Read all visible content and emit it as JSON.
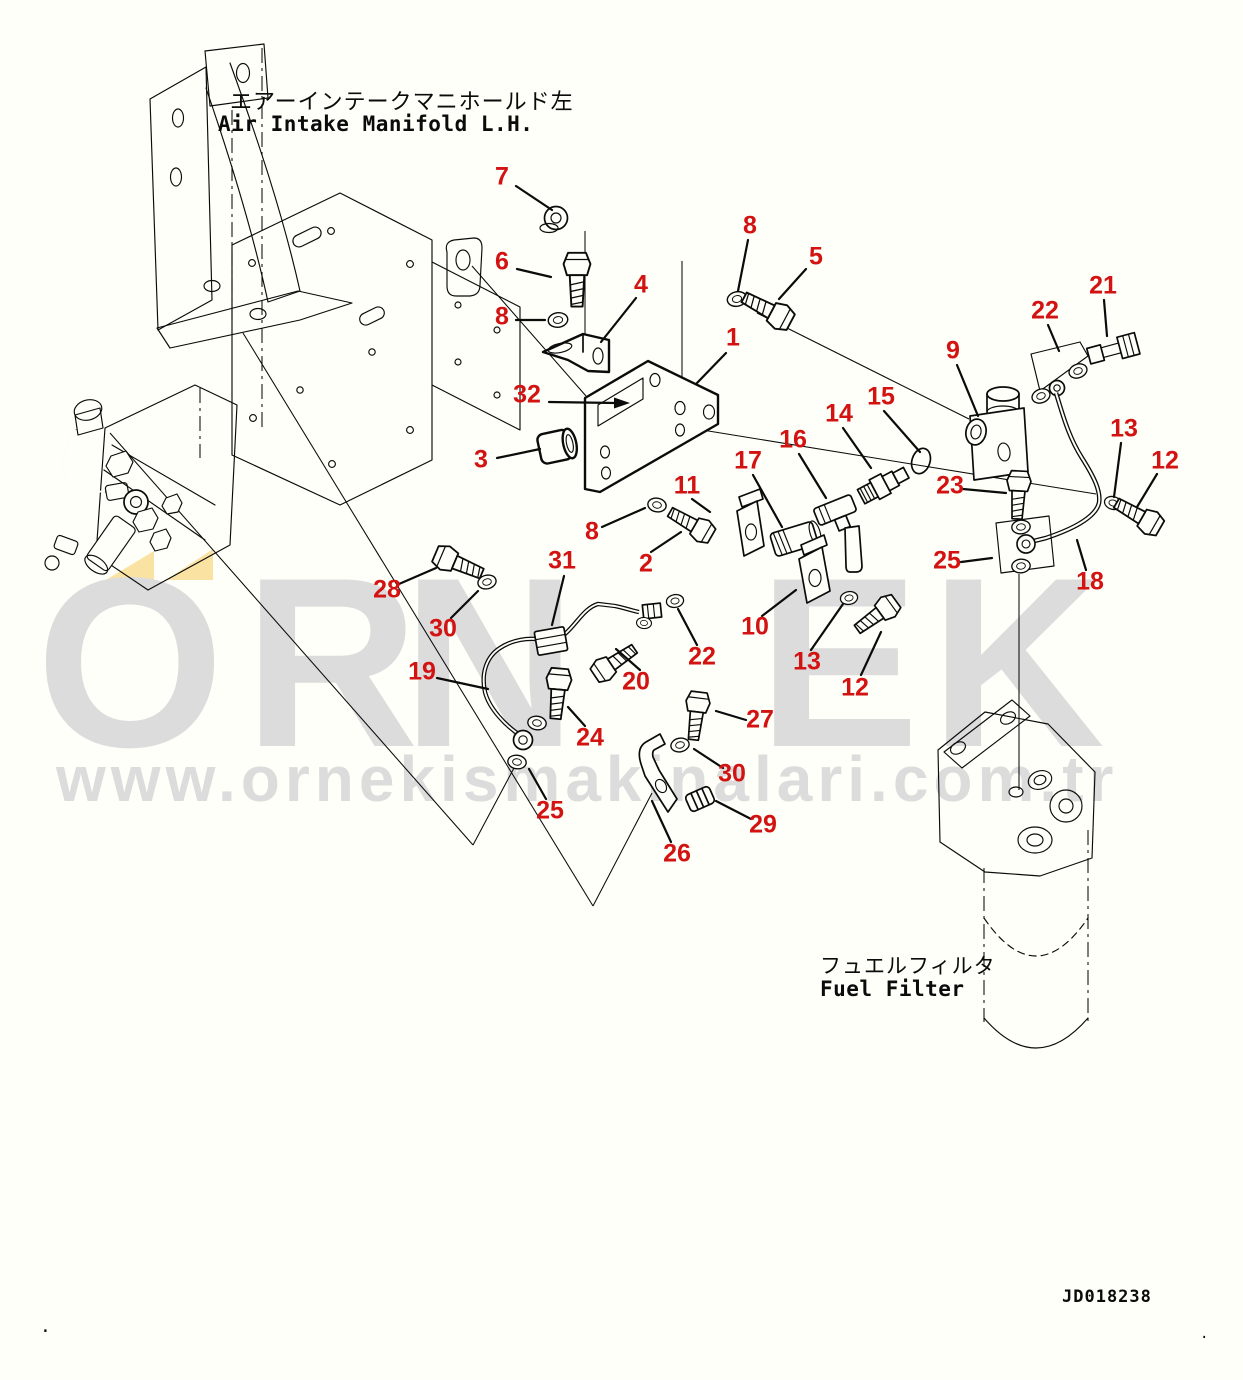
{
  "page": {
    "background": "#fdfff8",
    "drawing_number": "JD018238",
    "stray_dot_left": ".",
    "stray_dot_right": "."
  },
  "labels": {
    "air_intake_jp": "エアーインテークマニホールド左",
    "air_intake_en": "Air Intake Manifold L.H.",
    "fuel_filter_jp": "フュエルフィルタ",
    "fuel_filter_en": "Fuel Filter"
  },
  "watermark": {
    "brand": "ÖRNEK",
    "brand_display_letters": [
      "O",
      "R",
      "N",
      "E",
      "K"
    ],
    "url": "www.ornekismakinalari.com.tr",
    "letter_color": "#dcdcdc",
    "accent_color": "#fae3a2"
  },
  "colors": {
    "callout_red": "#d31212",
    "ink": "#0b0b0b"
  },
  "callouts": [
    {
      "n": "1",
      "x": 733,
      "y": 339
    },
    {
      "n": "2",
      "x": 646,
      "y": 565
    },
    {
      "n": "3",
      "x": 481,
      "y": 461
    },
    {
      "n": "4",
      "x": 641,
      "y": 286
    },
    {
      "n": "5",
      "x": 816,
      "y": 258
    },
    {
      "n": "6",
      "x": 502,
      "y": 263
    },
    {
      "n": "7",
      "x": 502,
      "y": 178
    },
    {
      "n": "8",
      "x": 502,
      "y": 318
    },
    {
      "n": "8",
      "x": 750,
      "y": 227
    },
    {
      "n": "8",
      "x": 592,
      "y": 533
    },
    {
      "n": "9",
      "x": 953,
      "y": 352
    },
    {
      "n": "10",
      "x": 755,
      "y": 628
    },
    {
      "n": "11",
      "x": 687,
      "y": 487
    },
    {
      "n": "12",
      "x": 1165,
      "y": 462
    },
    {
      "n": "12",
      "x": 855,
      "y": 689
    },
    {
      "n": "13",
      "x": 1124,
      "y": 430
    },
    {
      "n": "13",
      "x": 807,
      "y": 663
    },
    {
      "n": "14",
      "x": 839,
      "y": 415
    },
    {
      "n": "15",
      "x": 881,
      "y": 398
    },
    {
      "n": "16",
      "x": 793,
      "y": 441
    },
    {
      "n": "17",
      "x": 748,
      "y": 462
    },
    {
      "n": "18",
      "x": 1090,
      "y": 583
    },
    {
      "n": "19",
      "x": 422,
      "y": 673
    },
    {
      "n": "20",
      "x": 636,
      "y": 683
    },
    {
      "n": "21",
      "x": 1103,
      "y": 287
    },
    {
      "n": "22",
      "x": 1045,
      "y": 312
    },
    {
      "n": "22",
      "x": 702,
      "y": 658
    },
    {
      "n": "23",
      "x": 950,
      "y": 487
    },
    {
      "n": "24",
      "x": 590,
      "y": 739
    },
    {
      "n": "25",
      "x": 947,
      "y": 562
    },
    {
      "n": "25",
      "x": 550,
      "y": 812
    },
    {
      "n": "26",
      "x": 677,
      "y": 855
    },
    {
      "n": "27",
      "x": 760,
      "y": 721
    },
    {
      "n": "28",
      "x": 387,
      "y": 591
    },
    {
      "n": "29",
      "x": 763,
      "y": 826
    },
    {
      "n": "30",
      "x": 443,
      "y": 630
    },
    {
      "n": "30",
      "x": 732,
      "y": 775
    },
    {
      "n": "31",
      "x": 562,
      "y": 562
    },
    {
      "n": "32",
      "x": 527,
      "y": 396
    }
  ]
}
